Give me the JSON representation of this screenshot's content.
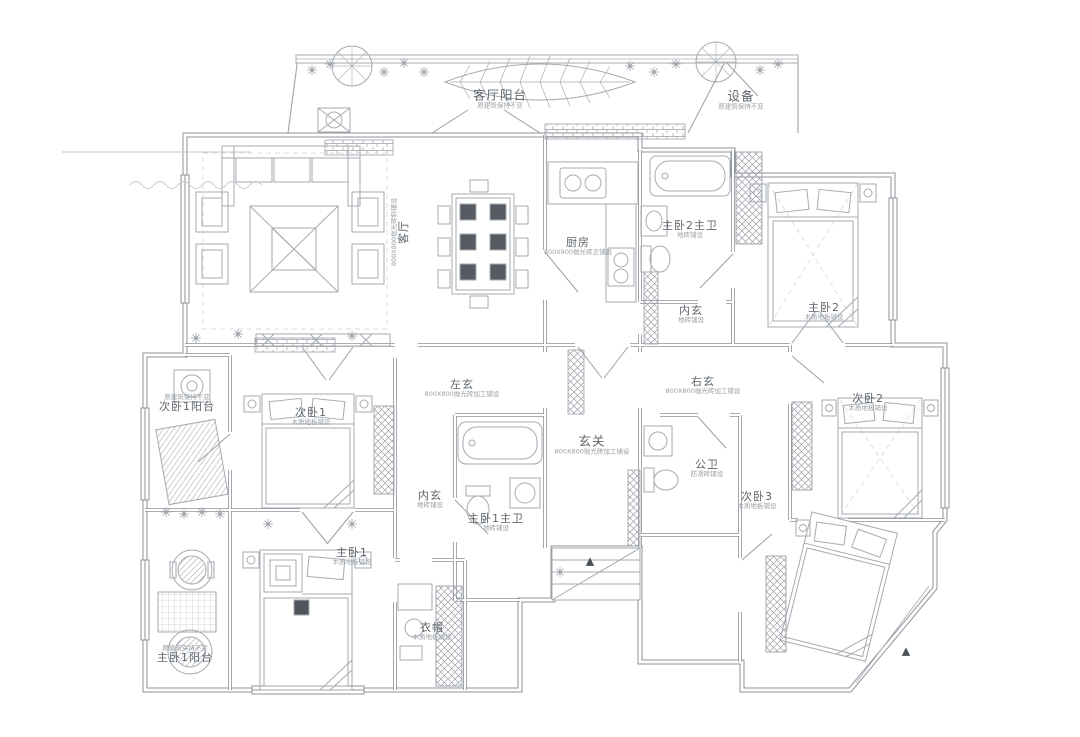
{
  "rooms": {
    "living_balcony": {
      "label": "客厅阳台",
      "note": "原建筑保持不变"
    },
    "equipment": {
      "label": "设备",
      "note": "原建筑保持不变"
    },
    "living": {
      "label": "客厅",
      "note": "800X800抛光砖斜铺设"
    },
    "kitchen": {
      "label": "厨房",
      "note": "800X800抛光砖正铺设"
    },
    "master2_bath": {
      "label": "主卧2主卫",
      "note": "地砖铺设"
    },
    "inner_hall_top": {
      "label": "内玄",
      "note": "地砖铺设"
    },
    "master2": {
      "label": "主卧2",
      "note": "木质地板铺设"
    },
    "bedroom1_balcony": {
      "label": "次卧1阳台",
      "note": "原建筑保持不变"
    },
    "bedroom1": {
      "label": "次卧1",
      "note": "木质地板铺设"
    },
    "left_hall": {
      "label": "左玄",
      "note": "800X800抛光砖加工铺设"
    },
    "right_hall": {
      "label": "右玄",
      "note": "800X800抛光砖加工铺设"
    },
    "entry": {
      "label": "玄关",
      "note": "800X800抛光砖加工铺设"
    },
    "bedroom2": {
      "label": "次卧2",
      "note": "木质地板铺设"
    },
    "public_bath": {
      "label": "公卫",
      "note": "防滑砖铺设"
    },
    "bedroom3": {
      "label": "次卧3",
      "note": "木质地板铺设"
    },
    "inner_hall_bottom": {
      "label": "内玄",
      "note": "地砖铺设"
    },
    "master1_bath": {
      "label": "主卧1主卫",
      "note": "地砖铺设"
    },
    "master1": {
      "label": "主卧1",
      "note": "木质地板铺设"
    },
    "cloak": {
      "label": "衣帽",
      "note": "木质地板铺设"
    },
    "master1_balcony": {
      "label": "主卧1阳台",
      "note": "原建筑保持不变"
    }
  },
  "icons": {
    "entry_marker": "▲"
  },
  "colors": {
    "background": "#ffffff",
    "wall_line": "#8e939a",
    "furniture_line": "#a6abb1",
    "label_text": "#5f666c",
    "note_text": "#9aa1a7",
    "dark_accent": "#565b61"
  }
}
